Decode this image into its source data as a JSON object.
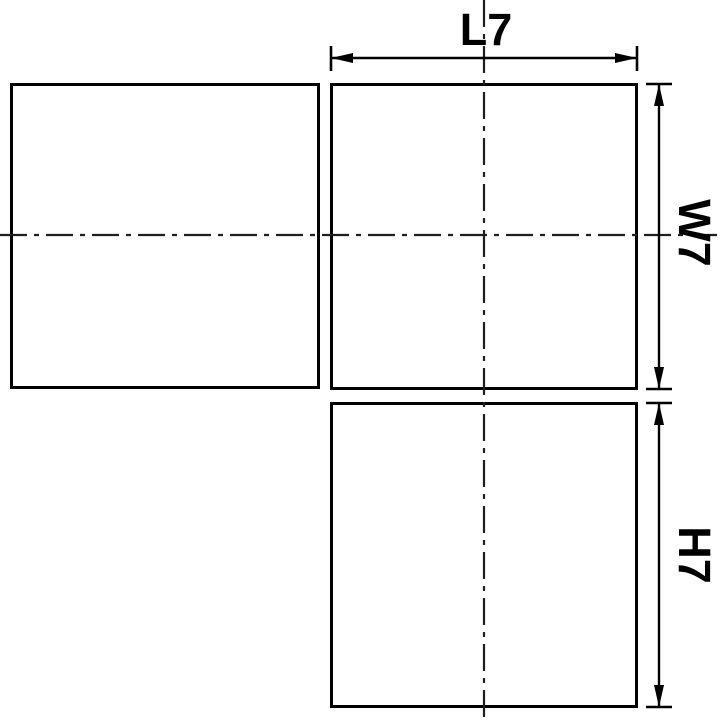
{
  "drawing": {
    "dimension_labels": {
      "length": "L7",
      "width": "W7",
      "height": "H7"
    },
    "colors": {
      "object_line": "#000000",
      "centerline": "#1f1f1f",
      "background": "#ffffff",
      "text": "#000000"
    }
  }
}
